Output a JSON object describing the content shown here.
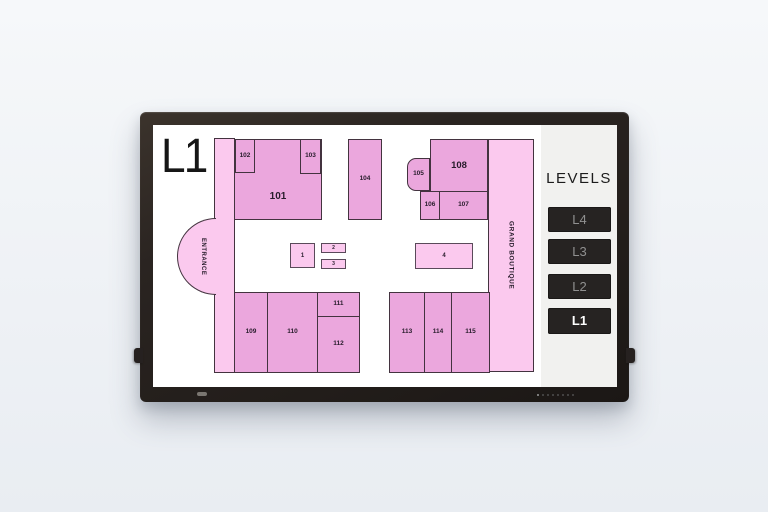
{
  "screen": {
    "level_title": "L1",
    "sidebar": {
      "title": "LEVELS",
      "buttons": [
        {
          "label": "L4",
          "active": false
        },
        {
          "label": "L3",
          "active": false
        },
        {
          "label": "L2",
          "active": false
        },
        {
          "label": "L1",
          "active": true
        }
      ]
    },
    "floorplan": {
      "entrance_label": "ENTRANCE",
      "grand_boutique_label": "GRAND BOUTIQUE",
      "colors": {
        "room_fill": "#EBA7DD",
        "corridor_fill": "#FBC9EE",
        "kiosk_fill": "#FBC9EE",
        "outline": "#43333F",
        "label": "#271C2B",
        "sidebar_bg": "#F1F1EF",
        "button_bg": "#262322",
        "active_button_text": "#FFFFFF",
        "inactive_button_text": "#909090"
      },
      "rooms": [
        {
          "label": "101",
          "x": 81,
          "y": 14,
          "w": 88,
          "h": 81,
          "fs": 10,
          "pt": 35
        },
        {
          "label": "102",
          "x": 82,
          "y": 14,
          "w": 20,
          "h": 34,
          "fs": 6.5
        },
        {
          "label": "103",
          "x": 147,
          "y": 14,
          "w": 21,
          "h": 35,
          "fs": 6.5
        },
        {
          "label": "104",
          "x": 195,
          "y": 14,
          "w": 34,
          "h": 81,
          "fs": 6.5
        },
        {
          "label": "105",
          "x": 254,
          "y": 33,
          "w": 23,
          "h": 33,
          "fs": 6.5,
          "shape": "rounded-left"
        },
        {
          "label": "108",
          "x": 277,
          "y": 14,
          "w": 58,
          "h": 53,
          "fs": 9.5
        },
        {
          "label": "106",
          "x": 267,
          "y": 66,
          "w": 20,
          "h": 29,
          "fs": 6.5
        },
        {
          "label": "107",
          "x": 286,
          "y": 66,
          "w": 49,
          "h": 29,
          "fs": 6.5
        },
        {
          "label": "109",
          "x": 81,
          "y": 167,
          "w": 34,
          "h": 81,
          "fs": 6.5
        },
        {
          "label": "110",
          "x": 114,
          "y": 167,
          "w": 51,
          "h": 81,
          "fs": 6.5
        },
        {
          "label": "111",
          "x": 164,
          "y": 167,
          "w": 43,
          "h": 25,
          "fs": 6.5
        },
        {
          "label": "112",
          "x": 164,
          "y": 191,
          "w": 43,
          "h": 57,
          "fs": 6.5
        },
        {
          "label": "113",
          "x": 236,
          "y": 167,
          "w": 36,
          "h": 81,
          "fs": 6.5
        },
        {
          "label": "114",
          "x": 271,
          "y": 167,
          "w": 28,
          "h": 81,
          "fs": 6.5
        },
        {
          "label": "115",
          "x": 298,
          "y": 167,
          "w": 39,
          "h": 81,
          "fs": 6.5
        },
        {
          "label": "1",
          "x": 137,
          "y": 118,
          "w": 25,
          "h": 25,
          "fs": 6,
          "type": "kiosk"
        },
        {
          "label": "2",
          "x": 168,
          "y": 118,
          "w": 25,
          "h": 10,
          "fs": 5,
          "type": "kiosk"
        },
        {
          "label": "3",
          "x": 168,
          "y": 134,
          "w": 25,
          "h": 10,
          "fs": 5,
          "type": "kiosk"
        },
        {
          "label": "4",
          "x": 262,
          "y": 118,
          "w": 58,
          "h": 26,
          "fs": 6,
          "type": "kiosk"
        }
      ]
    }
  }
}
